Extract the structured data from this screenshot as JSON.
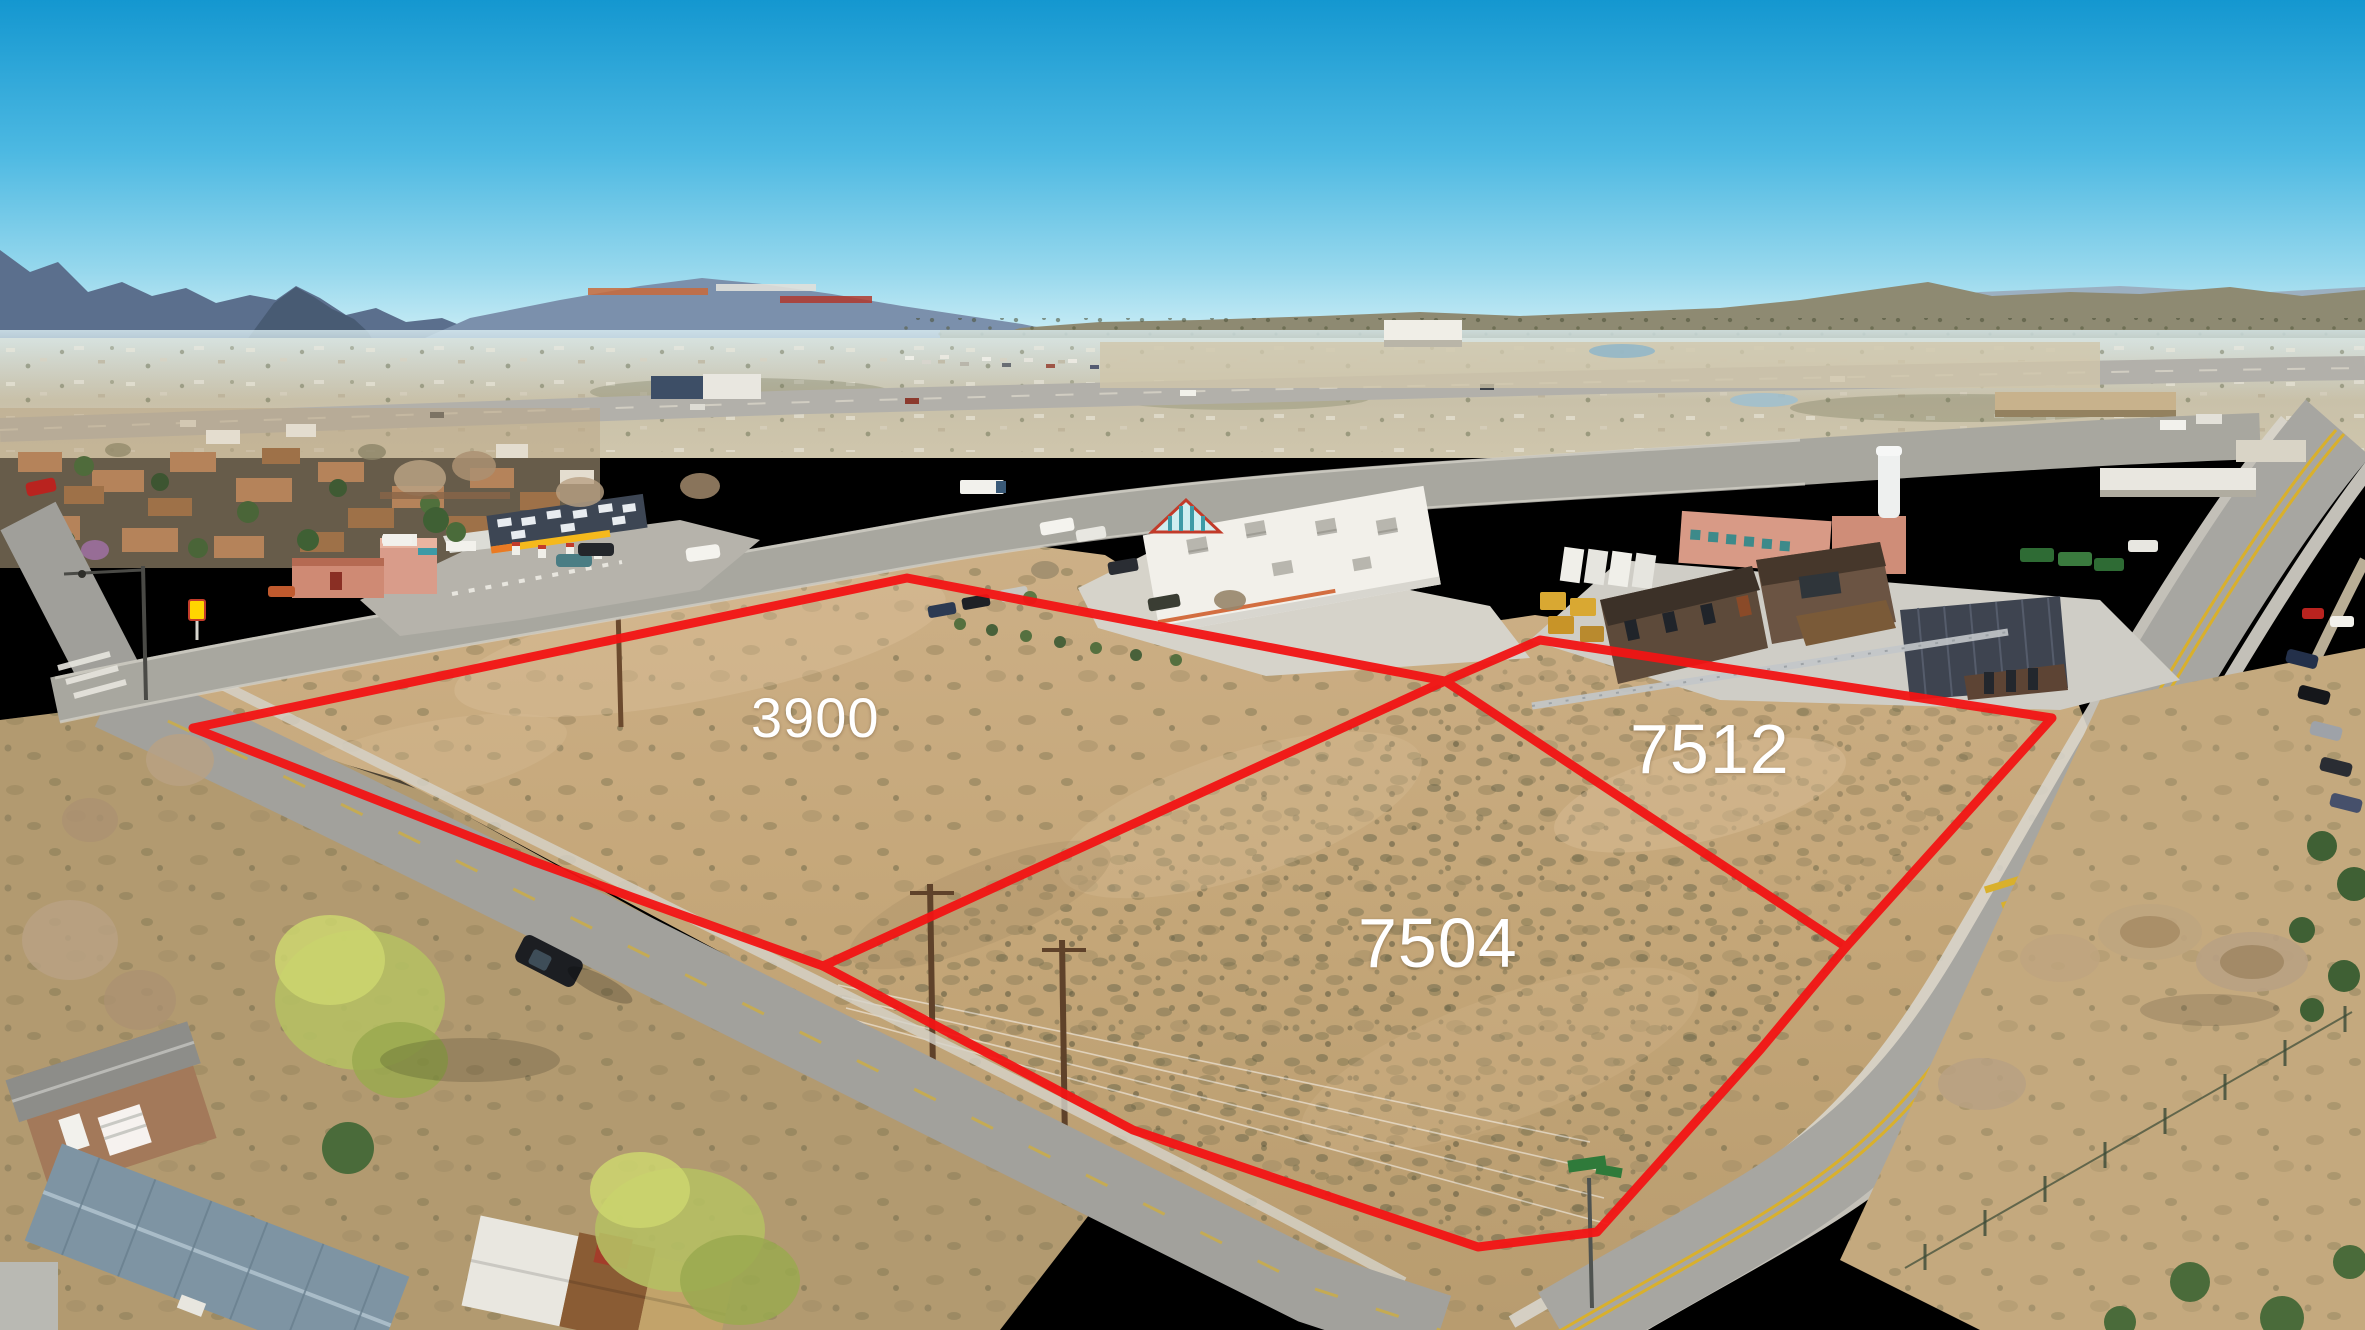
{
  "scene": {
    "type": "aerial-drone-photograph",
    "description": "Daytime aerial view of three vacant high-desert land parcels at a street corner, outlined in red, with a gas station, retail buildings, mobile homes, roads and mountains on the horizon",
    "sky_color_top": "#1497d0",
    "sky_color_horizon": "#cdeef6"
  },
  "parcels": {
    "outline_color": "#f21414",
    "label_color": "#ffffff",
    "items": [
      {
        "id": "lot-3900",
        "label": "3900"
      },
      {
        "id": "lot-7512",
        "label": "7512"
      },
      {
        "id": "lot-7504",
        "label": "7504"
      }
    ]
  },
  "landmarks": {
    "gas_station": "gas station with yellow canopy band",
    "retail_store": "large white flat-roof retail building",
    "modern_buildings": "dark-brown modern commercial buildings",
    "mobile_homes": "mobile home park",
    "mountains": "blue mountain ranges and juniper mesa"
  }
}
